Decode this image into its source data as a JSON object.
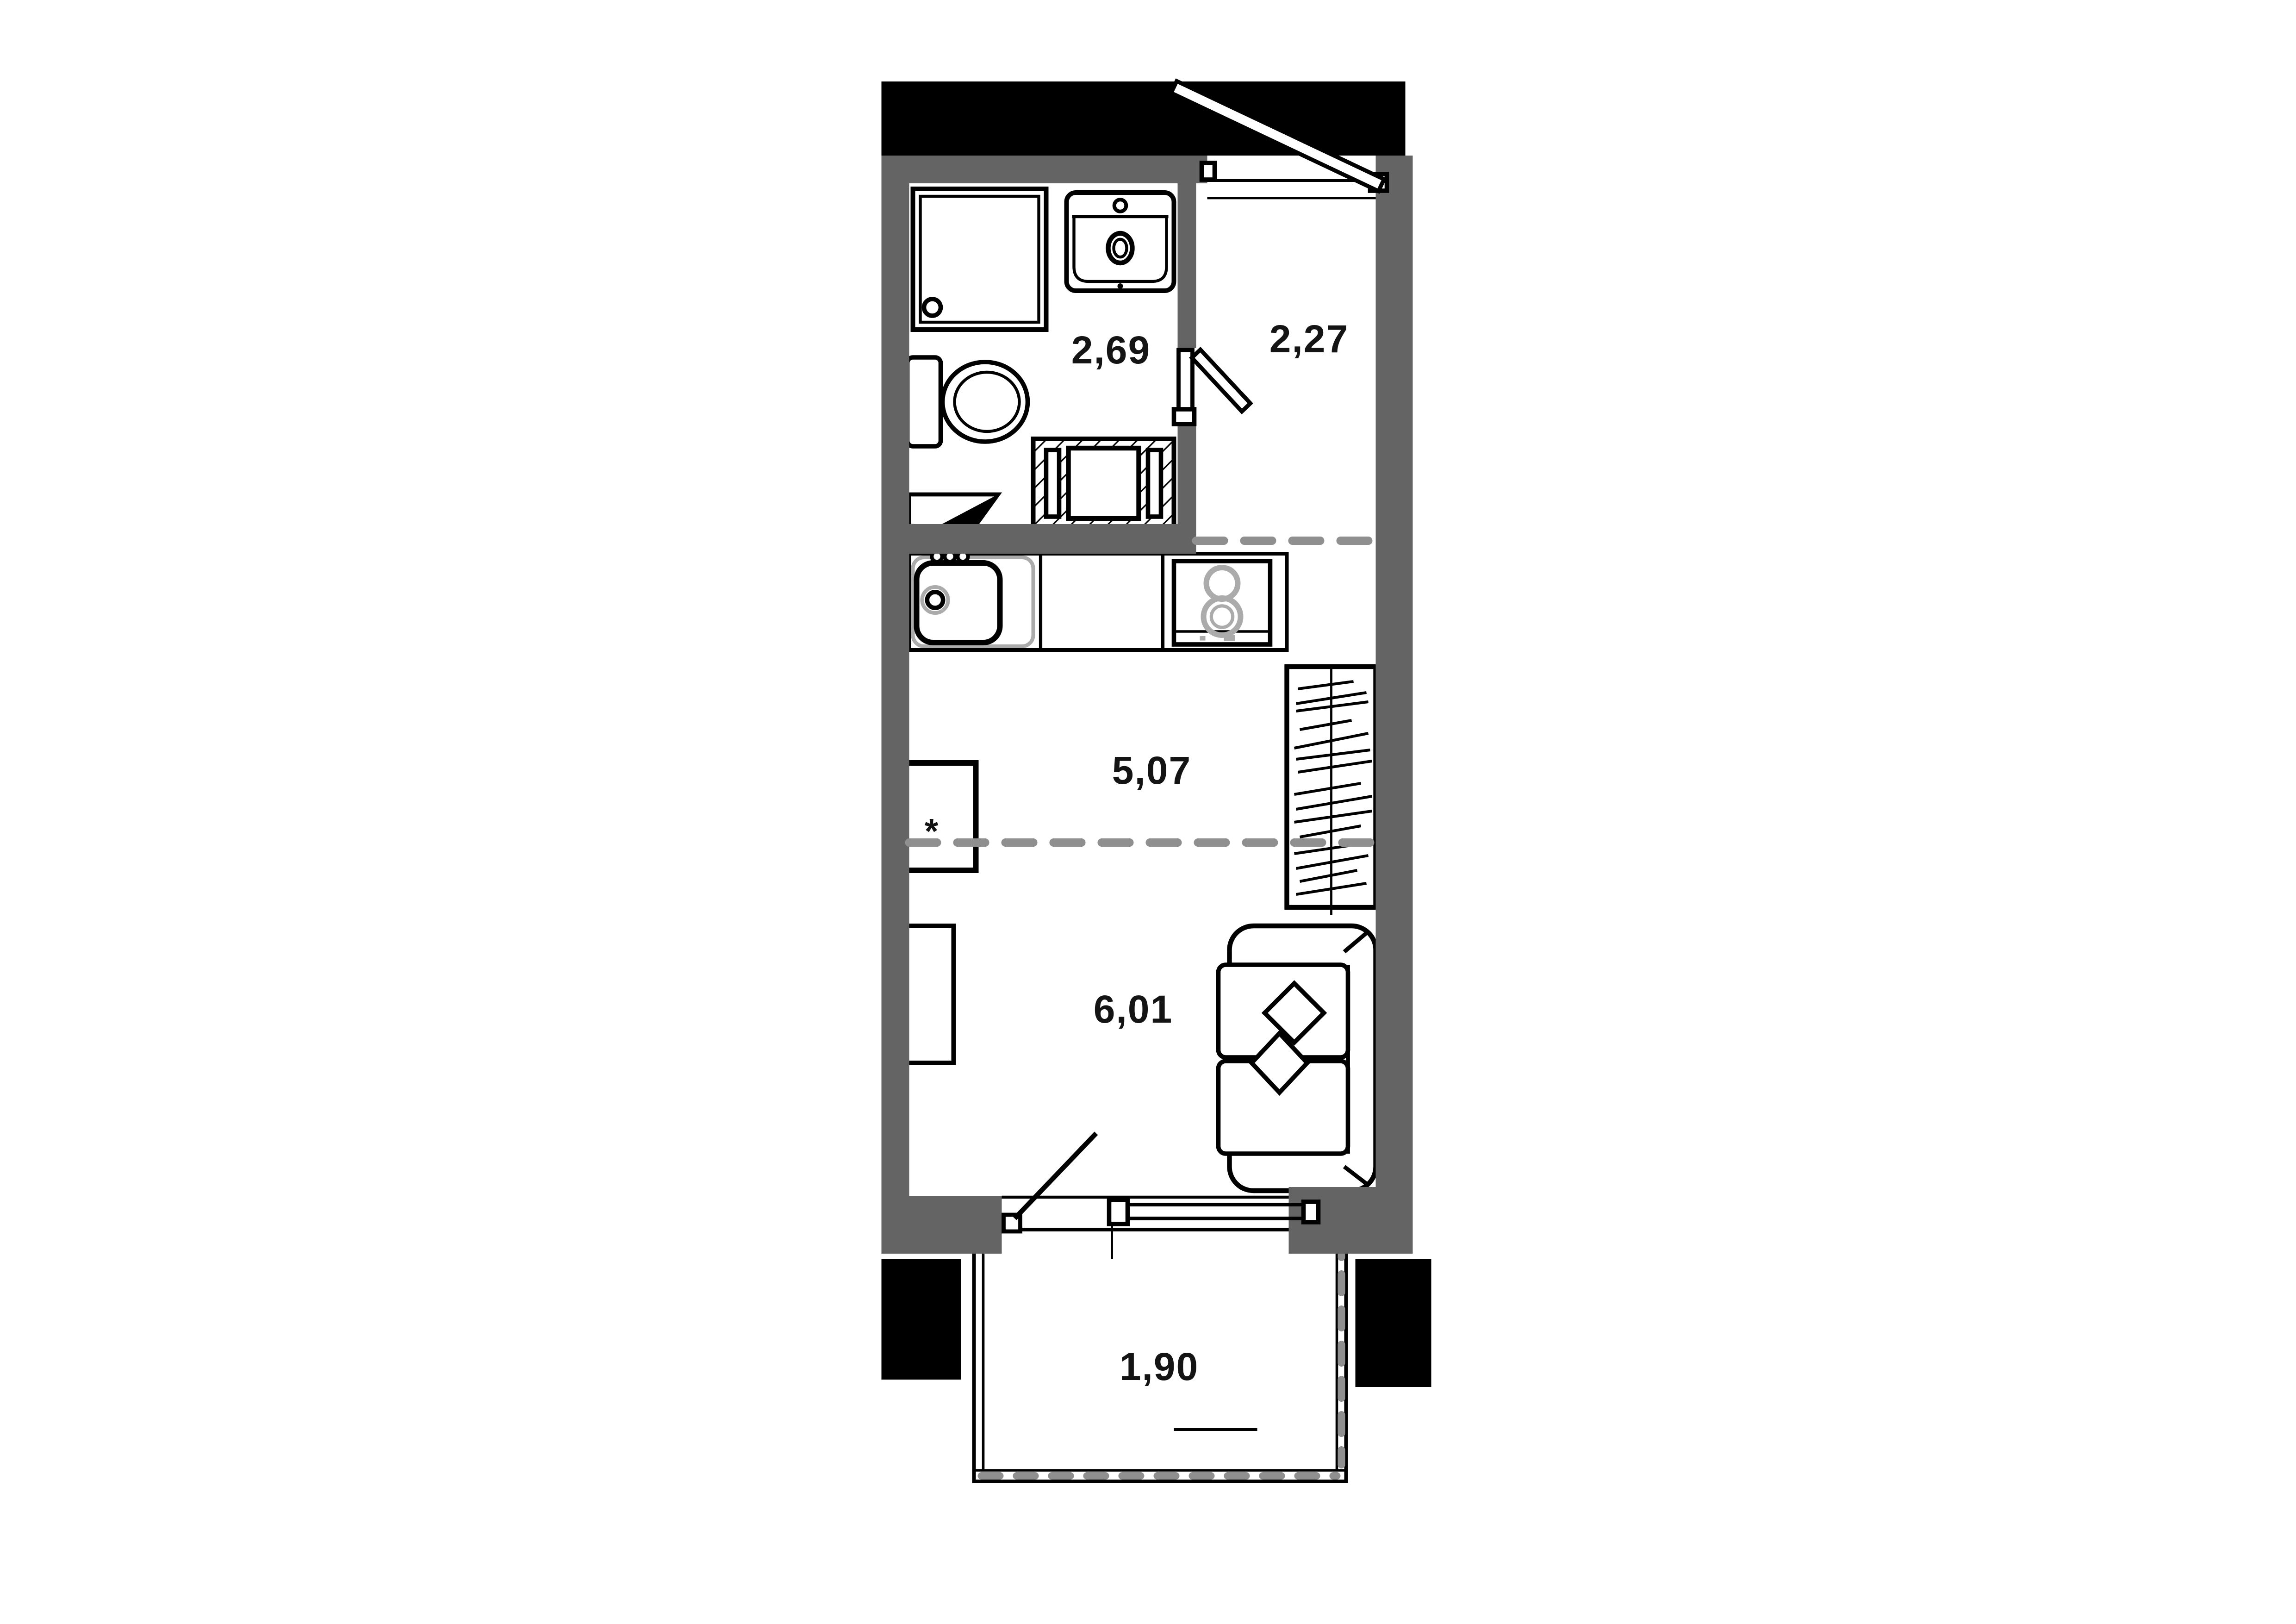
{
  "floor_plan": {
    "kind": "studio-apartment-floor-plan",
    "rooms": [
      {
        "name": "bathroom",
        "area_label": "2,69"
      },
      {
        "name": "hallway",
        "area_label": "2,27"
      },
      {
        "name": "kitchen-zone",
        "area_label": "5,07"
      },
      {
        "name": "living-zone",
        "area_label": "6,01"
      },
      {
        "name": "balcony",
        "area_label": "1,90"
      }
    ],
    "kitchen_table_marker": "*",
    "colors": {
      "background": "#ffffff",
      "walls": "#646464",
      "exterior_mass": "#000000",
      "line": "#000000",
      "zone_dashed": "#8f8f8f",
      "appliance_accent": "#ababab",
      "label_text": "#141414"
    }
  }
}
